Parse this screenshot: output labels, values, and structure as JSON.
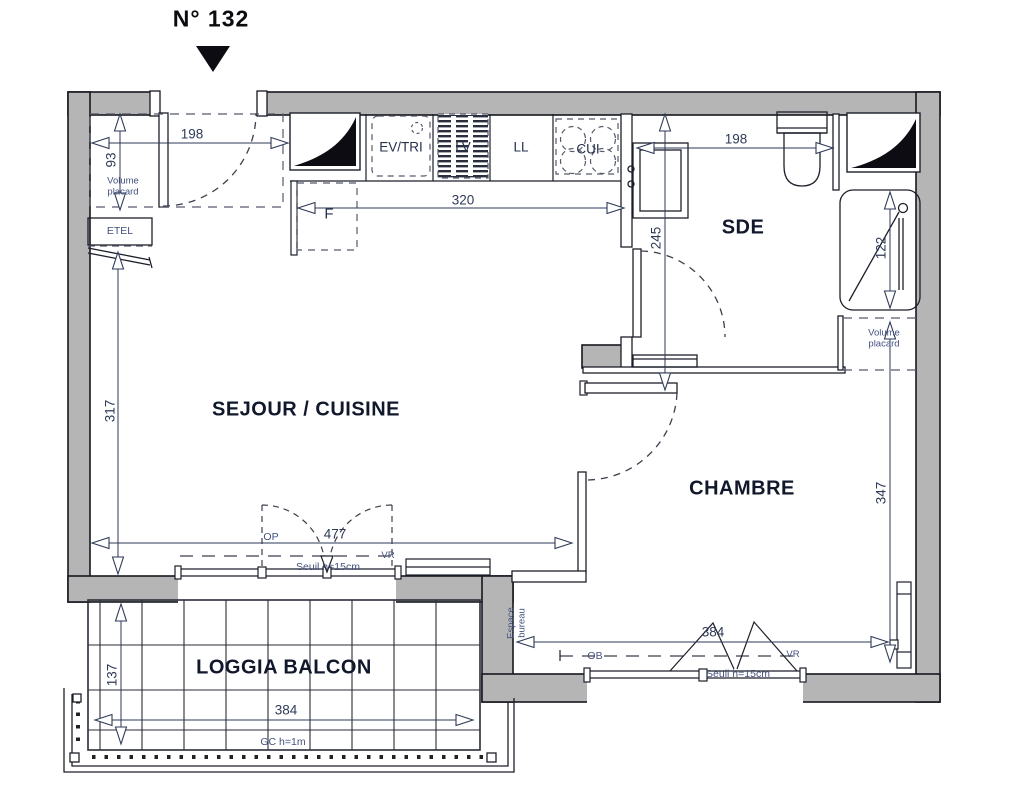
{
  "title": "N° 132",
  "colors": {
    "wall": "#b5b5b5",
    "line": "#1c1f2a",
    "annotation": "#44517e",
    "dim": "#2e3a57",
    "dash": "#4a4f5e"
  },
  "rooms": {
    "living": "SEJOUR / CUISINE",
    "bedroom": "CHAMBRE",
    "shower_room": "SDE",
    "balcony": "LOGGIA BALCON"
  },
  "fixtures": {
    "sink": "EV/TRI",
    "dishwasher": "LV",
    "washing_machine": "LL",
    "cooktop": "CUI",
    "fridge": "F",
    "electrical_panel": "ETEL"
  },
  "annotations": {
    "closet_left": {
      "l1": "Volume",
      "l2": "placard"
    },
    "closet_right": {
      "l1": "Volume",
      "l2": "placard"
    },
    "window_living": "OP",
    "shutter_living": "VR",
    "sill_living": "Seuil h=15cm",
    "window_bedroom": "OB",
    "shutter_bedroom": "VR",
    "sill_bedroom": "Seuil h=15cm",
    "guardrail": "GC h=1m",
    "desk": {
      "l1": "Espace",
      "l2": "bureau"
    }
  },
  "dimensions": {
    "entry_width": "198",
    "closet_depth": "93",
    "kitchen_run": "320",
    "sde_width": "198",
    "sde_depth": "245",
    "shower_length": "122",
    "living_depth": "317",
    "living_width": "477",
    "bedroom_depth": "347",
    "bedroom_width": "384",
    "balcony_width": "384",
    "balcony_depth": "137"
  }
}
